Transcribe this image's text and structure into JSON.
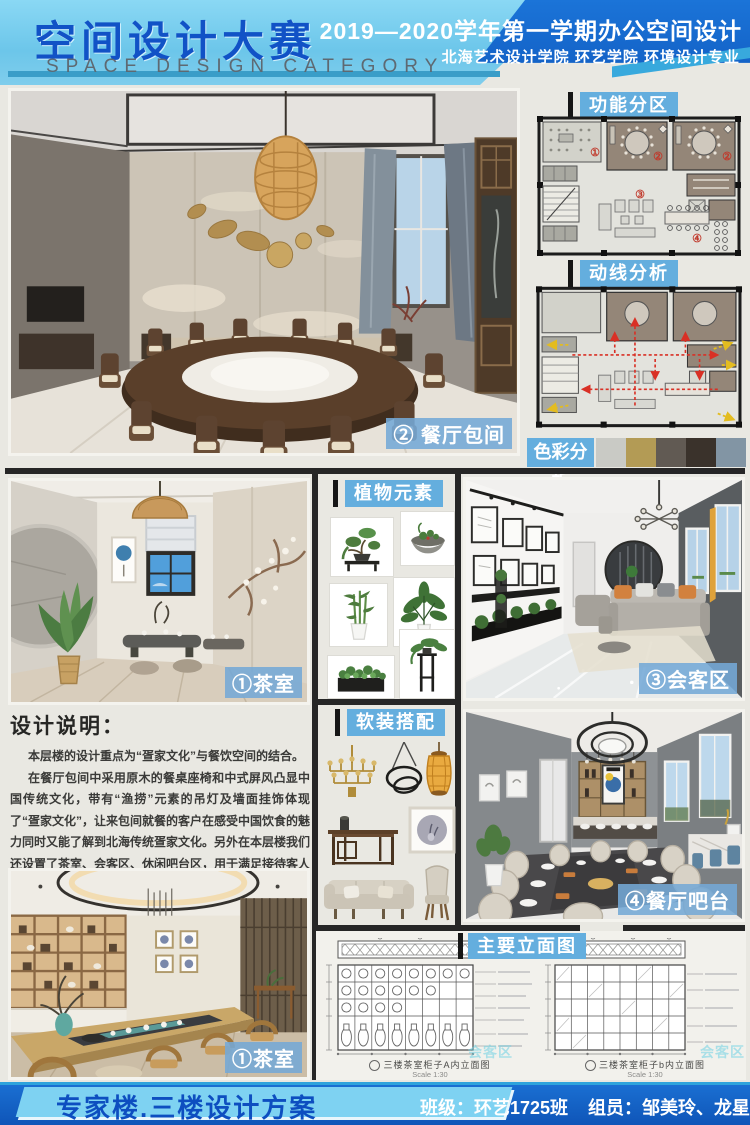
{
  "header": {
    "title_cn": "空间设计大赛",
    "title_en": "SPACE DESIGN CATEGORY",
    "course": "2019—2020学年第一学期办公空间设计",
    "school": "北海艺术设计学院  环艺学院  环境设计专业"
  },
  "section_labels": {
    "zoning": "功能分区",
    "circulation": "动线分析",
    "color": "色彩分析",
    "plants": "植物元素",
    "soft": "软装搭配",
    "elevation": "主要立面图"
  },
  "photo_labels": {
    "dining_room": "② 餐厅包间",
    "tea_room_mid": "①茶室",
    "meeting": "③会客区",
    "bar": "④餐厅吧台",
    "tea_room_bottom": "①茶室"
  },
  "design_notes": {
    "title": "设计说明：",
    "p1": "本层楼的设计重点为“疍家文化”与餐饮空间的结合。",
    "p2": "在餐厅包间中采用原木的餐桌座椅和中式屏风凸显中国传统文化，带有“渔捞”元素的吊灯及墙面挂饰体现了“疍家文化”，让来包间就餐的客户在感受中国饮食的魅力同时又能了解到北海传统疍家文化。另外在本层楼我们还设置了茶室、会客区、休闲吧台区，用于满足接待客人和就餐的需求。"
  },
  "floor_plan": {
    "numbers": [
      "①",
      "②",
      "②",
      "③",
      "④"
    ]
  },
  "color_swatches": [
    "#c9cac5",
    "#b39b55",
    "#615a53",
    "#3a322b",
    "#8295a4"
  ],
  "elevations": {
    "caption_a": "三楼茶室柜子A内立面图",
    "caption_b": "三楼茶室柜子b内立面图",
    "scale": "Scale 1:30"
  },
  "watermark": "会客区",
  "footer": {
    "project": "专家楼.三楼设计方案",
    "class": "班级：环艺1725班",
    "members": "组员：邹美玲、龙星羽、申成洁、付成军"
  }
}
